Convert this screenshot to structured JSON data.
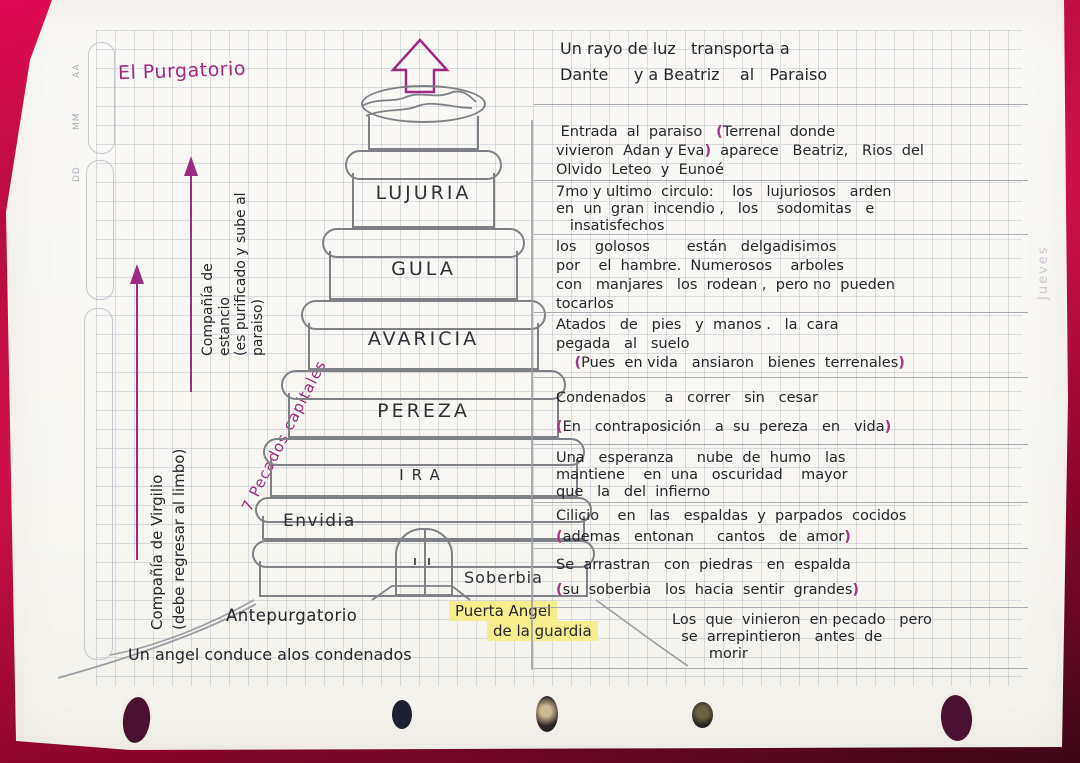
{
  "colors": {
    "ink": "#26262c",
    "pencil": "#85898e",
    "magenta": "#9e2b80",
    "paren": "#a23587",
    "highlight": "#f5ee8f",
    "paper": "#f8f7f3",
    "background": "#b60d3f"
  },
  "page": {
    "title": "El Purgatorio",
    "margin_letters": [
      "AA",
      "MM",
      "DD"
    ],
    "edge_note": "Jueves"
  },
  "left_annotations": {
    "virgil": {
      "label": "Compañía de Virgilio",
      "sub": "(debe regresar al limbo)"
    },
    "estacio": {
      "line1": "Compañía de",
      "line2": "estancio",
      "sub1": "(es purificado y sube al",
      "sub2": "paraiso)"
    },
    "sins": "7 Pecados capitales"
  },
  "tower": {
    "tiers": [
      "LUJURIA",
      "GULA",
      "AVARICIA",
      "PEREZA",
      "IRA",
      "Envidia",
      "Soberbia"
    ]
  },
  "base_labels": {
    "antepurgatorio": "Antepurgatorio",
    "gate1": "Puerta  Angel",
    "gate2": "de la guardia",
    "angel_note": "Un angel conduce alos condenados"
  },
  "notes": [
    {
      "lines": [
        "Un rayo de luz   transporta a",
        "Dante     y a Beatriz    al   Paraiso"
      ]
    },
    {
      "lines": [
        " Entrada  al  paraiso   (Terrenal  donde",
        "vivieron  Adan y Eva)  aparece   Beatriz,   Rios  del",
        "Olvido  Leteo  y  Eunoé"
      ]
    },
    {
      "lines": [
        "7mo y ultimo  circulo:    los   lujuriosos   arden",
        "en  un  gran  incendio ,   los    sodomitas   e",
        "   insatisfechos"
      ]
    },
    {
      "lines": [
        "los    golosos        están   delgadisimos",
        "por    el  hambre.  Numerosos    arboles",
        "con   manjares   los  rodean ,  pero no  pueden",
        "tocarlos"
      ]
    },
    {
      "lines": [
        "Atados   de   pies   y  manos .   la  cara",
        "pegada   al   suelo",
        "    (Pues  en vida   ansiaron   bienes  terrenales)"
      ]
    },
    {
      "lines": [
        "Condenados    a   correr   sin   cesar",
        "(En   contraposición   a  su  pereza   en   vida)"
      ]
    },
    {
      "lines": [
        "Una   esperanza     nube  de  humo   las",
        "mantiene    en  una   oscuridad    mayor",
        "que   la   del  infierno"
      ]
    },
    {
      "lines": [
        "Cilicio    en   las   espaldas  y  parpados  cocidos",
        "(ademas   entonan     cantos   de  amor)"
      ]
    },
    {
      "lines": [
        "Se  arrastran   con  piedras   en  espalda",
        "(su  soberbia   los  hacia  sentir  grandes)"
      ]
    },
    {
      "lines": [
        "Los  que  vinieron  en pecado   pero",
        "  se  arrepintieron   antes  de",
        "        morir"
      ]
    }
  ]
}
